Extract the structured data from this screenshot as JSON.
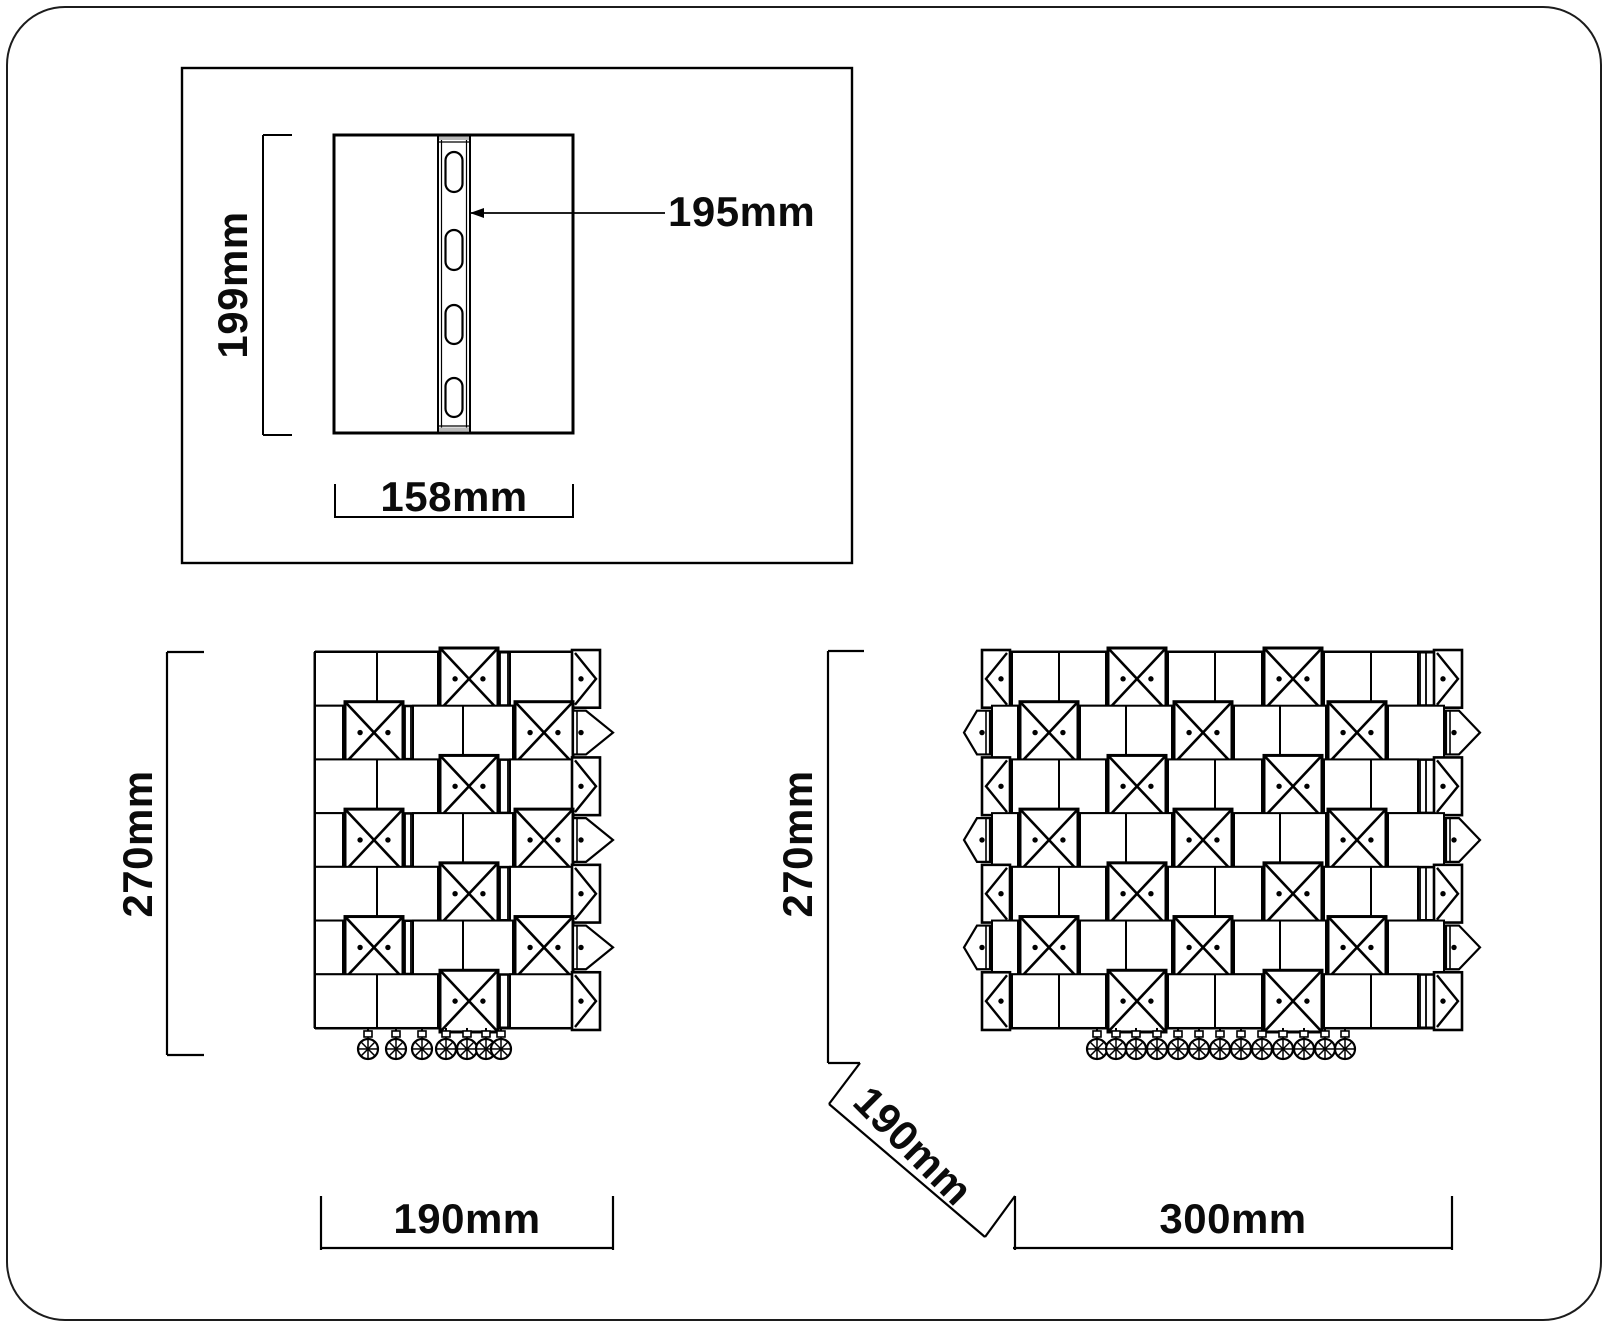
{
  "drawing": {
    "title": "crystal-wall-light-dimension-diagram",
    "colors": {
      "line": "#000000",
      "background": "#ffffff",
      "text": "#0b0b0b"
    },
    "backplate_view": {
      "height_label": "199mm",
      "width_label": "158mm",
      "bracket_label": "195mm"
    },
    "side_view": {
      "height_label": "270mm",
      "width_label": "190mm"
    },
    "front_view": {
      "height_label": "270mm",
      "depth_label": "190mm",
      "width_label": "300mm"
    }
  }
}
